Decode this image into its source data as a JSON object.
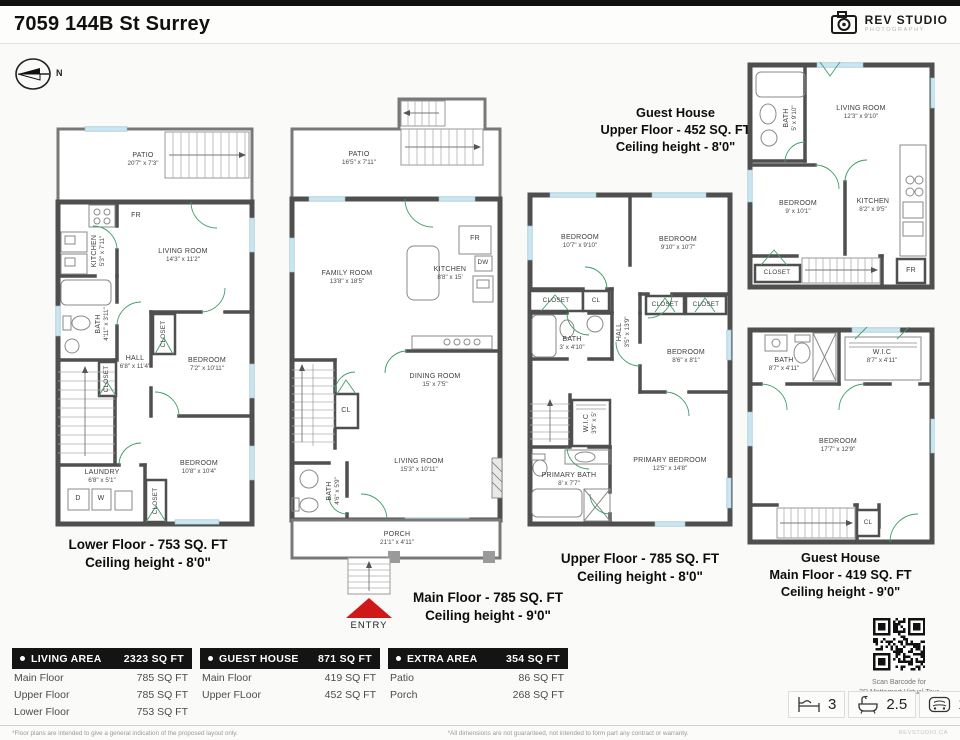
{
  "header": {
    "title": "7059 144B St Surrey",
    "logo": {
      "name": "REV STUDIO",
      "sub": "PHOTOGRAPHY"
    }
  },
  "compass": {
    "north": "N"
  },
  "plans": {
    "lower": {
      "caption_line1": "Lower Floor - 753 SQ. FT",
      "caption_line2": "Ceiling height - 8'0\"",
      "rooms": {
        "patio": {
          "name": "PATIO",
          "dims": "20'7\" x 7'3\""
        },
        "fr": {
          "name": "FR"
        },
        "kitchen": {
          "name": "KITCHEN",
          "dims": "5'3\" x 7'11\""
        },
        "living": {
          "name": "LIVING ROOM",
          "dims": "14'3\" x 11'2\""
        },
        "bath": {
          "name": "BATH",
          "dims": "4'11\" x 3'11\""
        },
        "hall": {
          "name": "HALL",
          "dims": "6'8\" x 11'4\""
        },
        "closet_hall": {
          "name": "CLOSET"
        },
        "bedroom1": {
          "name": "BEDROOM",
          "dims": "7'2\" x 10'11\""
        },
        "closet_bedroom1": {
          "name": "CLOSET"
        },
        "bedroom2": {
          "name": "BEDROOM",
          "dims": "10'8\" x 10'4\""
        },
        "closet_bedroom2": {
          "name": "CLOSET"
        },
        "laundry": {
          "name": "LAUNDRY",
          "dims": "6'8\" x 5'1\""
        },
        "dryer": {
          "name": "D"
        },
        "washer": {
          "name": "W"
        }
      }
    },
    "main": {
      "caption_line1": "Main Floor - 785 SQ. FT",
      "caption_line2": "Ceiling height - 9'0\"",
      "rooms": {
        "patio": {
          "name": "PATIO",
          "dims": "16'5\" x 7'11\""
        },
        "family": {
          "name": "FAMILY ROOM",
          "dims": "13'8\" x 18'5\""
        },
        "kitchen": {
          "name": "KITCHEN",
          "dims": "8'8\" x 15'"
        },
        "fr": {
          "name": "FR"
        },
        "dw": {
          "name": "DW"
        },
        "dining": {
          "name": "DINING ROOM",
          "dims": "15' x 7'5\""
        },
        "cl": {
          "name": "CL"
        },
        "living": {
          "name": "LIVING ROOM",
          "dims": "15'3\" x 10'11\""
        },
        "bath": {
          "name": "BATH",
          "dims": "4'6\" x 5'9\""
        },
        "porch": {
          "name": "PORCH",
          "dims": "21'1\" x 4'11\""
        },
        "entry": {
          "name": "ENTRY"
        }
      }
    },
    "upper": {
      "caption_line1": "Upper Floor - 785 SQ. FT",
      "caption_line2": "Ceiling height - 8'0\"",
      "rooms": {
        "bedroom1": {
          "name": "BEDROOM",
          "dims": "10'7\" x 9'10\""
        },
        "bedroom2": {
          "name": "BEDROOM",
          "dims": "9'10\" x 10'7\""
        },
        "closet1": {
          "name": "CLOSET"
        },
        "cl": {
          "name": "CL"
        },
        "closet2": {
          "name": "CLOSET"
        },
        "closet3": {
          "name": "CLOSET"
        },
        "hall": {
          "name": "HALL",
          "dims": "3'5\" x 13'9\""
        },
        "bath": {
          "name": "BATH",
          "dims": "3' x 4'10\""
        },
        "bedroom3": {
          "name": "BEDROOM",
          "dims": "8'6\" x 8'1\""
        },
        "wic": {
          "name": "W.I.C",
          "dims": "3'9\" x 5'"
        },
        "primary_bath": {
          "name": "PRIMARY BATH",
          "dims": "8' x 7'7\""
        },
        "primary_bedroom": {
          "name": "PRIMARY BEDROOM",
          "dims": "12'5\" x 14'8\""
        }
      }
    },
    "guest_upper": {
      "caption_line1": "Guest House",
      "caption_line2": "Upper Floor - 452 SQ. FT",
      "caption_line3": "Ceiling height - 8'0\"",
      "rooms": {
        "bath": {
          "name": "BATH",
          "dims": "5' x 9'10\""
        },
        "living": {
          "name": "LIVING ROOM",
          "dims": "12'3\" x 9'10\""
        },
        "bedroom": {
          "name": "BEDROOM",
          "dims": "9' x 10'1\""
        },
        "kitchen": {
          "name": "KITCHEN",
          "dims": "8'2\" x 9'5\""
        },
        "closet": {
          "name": "CLOSET"
        },
        "fr": {
          "name": "FR"
        }
      }
    },
    "guest_main": {
      "caption_line1": "Guest House",
      "caption_line2": "Main Floor - 419 SQ. FT",
      "caption_line3": "Ceiling height - 9'0\"",
      "rooms": {
        "bath": {
          "name": "BATH",
          "dims": "8'7\" x 4'11\""
        },
        "wic": {
          "name": "W.I.C",
          "dims": "8'7\" x 4'11\""
        },
        "bedroom": {
          "name": "BEDROOM",
          "dims": "17'7\" x 12'9\""
        },
        "cl": {
          "name": "CL"
        }
      }
    }
  },
  "tables": [
    {
      "title": "LIVING AREA",
      "total": "2323 SQ FT",
      "rows": [
        [
          "Main Floor",
          "785 SQ FT"
        ],
        [
          "Upper Floor",
          "785 SQ FT"
        ],
        [
          "Lower Floor",
          "753 SQ FT"
        ]
      ]
    },
    {
      "title": "GUEST HOUSE",
      "total": "871 SQ FT",
      "rows": [
        [
          "Main Floor",
          "419 SQ FT"
        ],
        [
          "Upper FLoor",
          "452 SQ FT"
        ]
      ]
    },
    {
      "title": "EXTRA AREA",
      "total": "354 SQ FT",
      "rows": [
        [
          "Patio",
          "86 SQ FT"
        ],
        [
          "Porch",
          "268 SQ FT"
        ]
      ]
    }
  ],
  "qr": {
    "caption_line1": "Scan Barcode for",
    "caption_line2": "3D Matterport Virtual Tour"
  },
  "summary": {
    "beds": "3",
    "baths": "2.5",
    "garage": "1"
  },
  "footer": {
    "left": "*Floor plans are intended to give a general indication of the proposed layout only.",
    "center": "*All dimensions are not guaranteed, not intended to form part any contract or warranty.",
    "right": "REVSTUDIO.CA"
  },
  "colors": {
    "wall": "#4f4f4f",
    "window": "#c9e6f2",
    "door": "#3f9e68",
    "entry_arrow": "#d01818"
  }
}
